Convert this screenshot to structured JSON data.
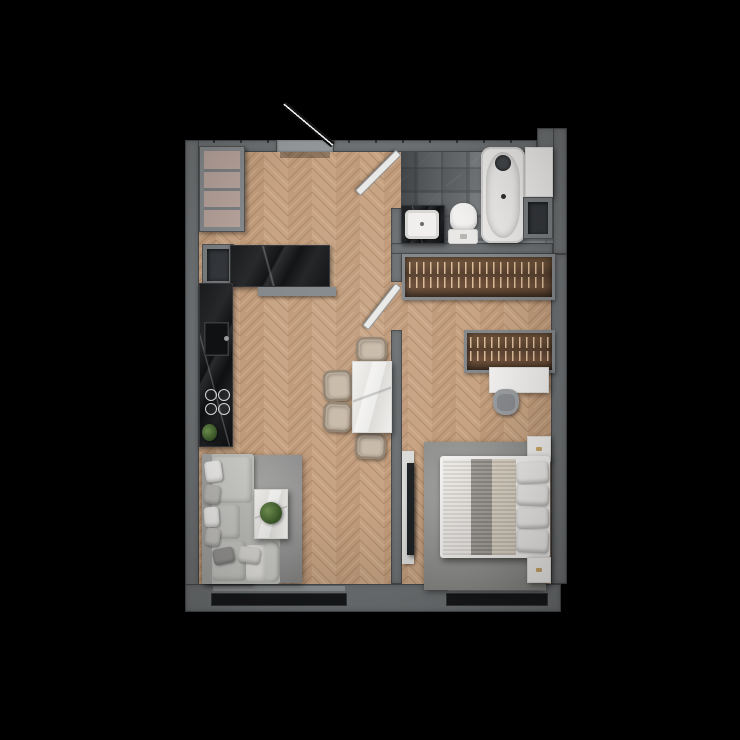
{
  "scene": {
    "description": "Top-down 3D rendered floor plan of a one-bedroom apartment on a black background, herringbone wood flooring",
    "background": "#000000"
  },
  "palette": {
    "wall": "#6f7274",
    "wallLight": "#95989a",
    "floorWood": "#c7a383",
    "floorGroove": "#9c7a58",
    "tileBase": "#75797c",
    "tileDark": "#1c1e21",
    "glass": "#17181a",
    "sill": "#8f9294",
    "counterBlack": "#161719",
    "furnitureWhite": "#efeeec",
    "panelWhite": "#dadad8",
    "sofaGray": "#bcbcb9",
    "backrestGray": "#a3a3a1",
    "cushionGray": "#c9c9c6",
    "rugGray": "#9b9b99",
    "wardrobeWood": "#6b4e37",
    "chairBeige": "#b7a997",
    "deskChairGray": "#9a9da0",
    "tvBlack": "#1f2224",
    "plantGreen": "#4d7038",
    "shelfCellBeige": "#b5a29a",
    "brassHandle": "#c9a86a",
    "doorDark": "#141414",
    "doorWhite": "#e9e9e7"
  },
  "rooms": [
    {
      "id": "entry",
      "furniture": [
        "entrance-door",
        "open-shelf-unit"
      ]
    },
    {
      "id": "kitchen",
      "furniture": [
        "black-marble-counter-run",
        "upper-counter-block",
        "kitchen-sink",
        "cooktop-4-burners",
        "plant",
        "wall-niche"
      ]
    },
    {
      "id": "living-dining",
      "furniture": [
        "corner-sofa",
        "decorative-pillows",
        "coffee-table-with-plant",
        "area-rug",
        "dining-table",
        "dining-chairs-x4"
      ]
    },
    {
      "id": "bathroom",
      "furniture": [
        "bathtub-with-faucet",
        "toilet",
        "countertop-basin",
        "storage-shelf",
        "wall-niche",
        "door"
      ]
    },
    {
      "id": "bedroom",
      "furniture": [
        "double-bed",
        "pillows-x4",
        "nightstand-top",
        "nightstand-bottom",
        "wardrobe-top",
        "wardrobe-mid",
        "desk",
        "desk-chair",
        "wall-mounted-tv",
        "area-rug",
        "door"
      ]
    }
  ],
  "counts": {
    "windows": 2,
    "doors": 3
  }
}
